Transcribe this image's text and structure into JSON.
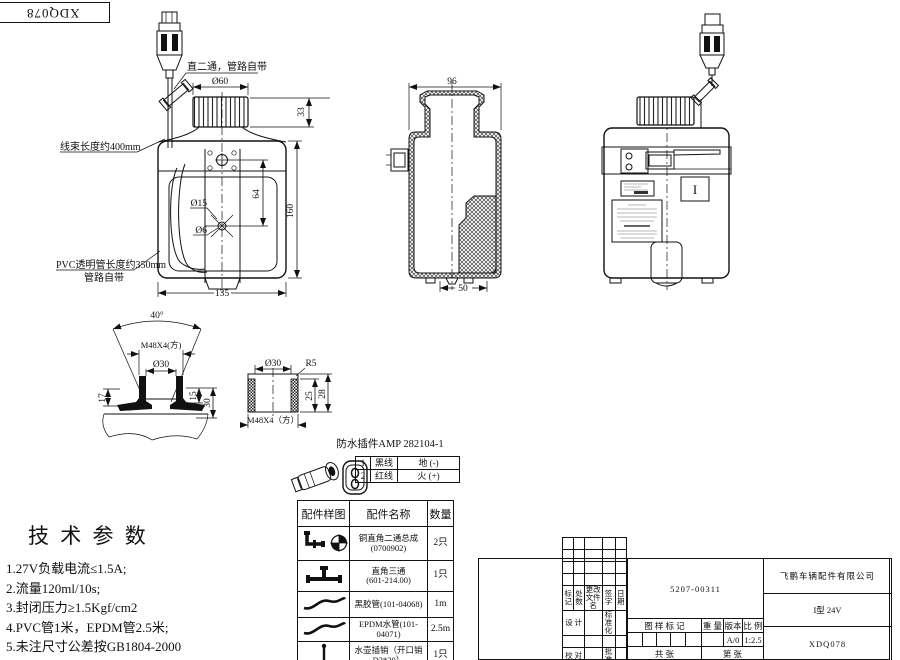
{
  "corner_code": "XDQ078",
  "views": {
    "front": {
      "note_fitting": "直二通，管路自带",
      "note_harness": "线束长度约400mm",
      "note_pvc_line1": "PVC透明管长度约350mm",
      "note_pvc_line2": "管路自带",
      "dim_cap_dia": "Ø60",
      "dim_cap_h": "33",
      "dim_d15": "Ø15",
      "dim_d6": "Ø6",
      "dim_64": "64",
      "dim_h": "160",
      "dim_w": "135"
    },
    "section": {
      "dim_top": "96",
      "dim_bottom": "50"
    },
    "side": {
      "mark": "I"
    },
    "detail_funnel": {
      "dim_angle": "40°",
      "dim_thread": "M48X4(方)",
      "dim_dia": "Ø30",
      "dim_17": "17",
      "dim_15": "15",
      "dim_30": "30"
    },
    "detail_cap": {
      "dim_dia": "Ø30",
      "dim_r": "R5",
      "dim_25": "25",
      "dim_28": "28",
      "dim_thread": "M48X4（方）"
    }
  },
  "connector": {
    "title": "防水插件AMP 282104-1",
    "pins": [
      {
        "no": "1",
        "wire": "黑线",
        "signal": "地 (-)"
      },
      {
        "no": "2",
        "wire": "红线",
        "signal": "火 (+)"
      }
    ]
  },
  "parts_table": {
    "headers": [
      "配件样图",
      "配件名称",
      "数量"
    ],
    "rows": [
      {
        "icon": "elbow-assembly-icon",
        "name": "铜直角二通总成",
        "code": "(0700902)",
        "qty": "2只"
      },
      {
        "icon": "tee-fitting-icon",
        "name": "直角三通",
        "code": "(601-214.00)",
        "qty": "1只"
      },
      {
        "icon": "hose-icon",
        "name": "黑胶管(101-04068)",
        "code": "",
        "qty": "1m"
      },
      {
        "icon": "hose-icon",
        "name": "EPDM水管(101-04071)",
        "code": "",
        "qty": "2.5m"
      },
      {
        "icon": "pin-icon",
        "name": "水壶插销（开口销",
        "code": "D3*30）",
        "qty": "1只"
      }
    ]
  },
  "tech_params": {
    "title": "技 术 参 数",
    "items": [
      "1.27V负载电流≤1.5A;",
      "2.流量120ml/10s;",
      "3.封闭压力≥1.5Kgf/cm2",
      "4.PVC管1米，EPDM管2.5米;",
      "5.未注尺寸公差按GB1804-2000"
    ]
  },
  "title_block": {
    "part_no": "5207-00311",
    "company": "飞鹏车辆配件有限公司",
    "model": "I型 24V",
    "drawing_no": "XDQ078",
    "rev_headers": [
      "标记",
      "处数",
      "更改文件名",
      "签 字",
      "日 期"
    ],
    "role_design": "设 计",
    "role_standard": "标准化",
    "role_check": "校 对",
    "role_approve": "批 准",
    "role_review": "审 核",
    "role_date": "日 期",
    "stamp_label": "图 样 标 记",
    "weight_label": "重 量",
    "version_label": "版本",
    "scale_label": "比 例",
    "version": "A/0",
    "scale": "1:2.5",
    "sheet_total": "共    张",
    "sheet_no": "第    张"
  }
}
